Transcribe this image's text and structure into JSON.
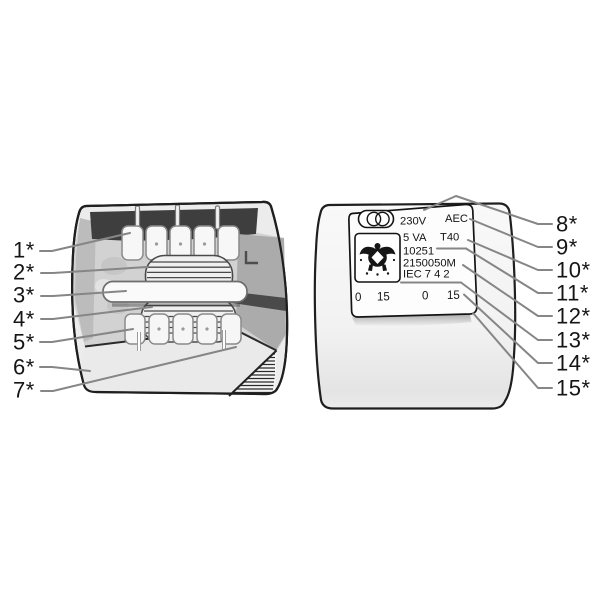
{
  "colors": {
    "background": "#ffffff",
    "ink": "#141414",
    "leader_line": "#868686",
    "callout_text": "#151515"
  },
  "left_unit": {
    "callouts": [
      "1*",
      "2*",
      "3*",
      "4*",
      "5*",
      "6*",
      "7*"
    ]
  },
  "right_unit": {
    "callouts": [
      "8*",
      "9*",
      "10*",
      "11*",
      "12*",
      "13*",
      "14*",
      "15*"
    ],
    "label": {
      "voltage": "230V",
      "maker": "AEC",
      "power": "5 VA",
      "thermal_class": "T40",
      "code": "10251",
      "model": "2150050M",
      "standard": "IEC 7 4 2",
      "terminals": [
        "0",
        "15",
        "0",
        "15"
      ]
    },
    "icons": {
      "symbol": "transformer-symbol-icon",
      "certification": "certification-mark-icon"
    }
  }
}
